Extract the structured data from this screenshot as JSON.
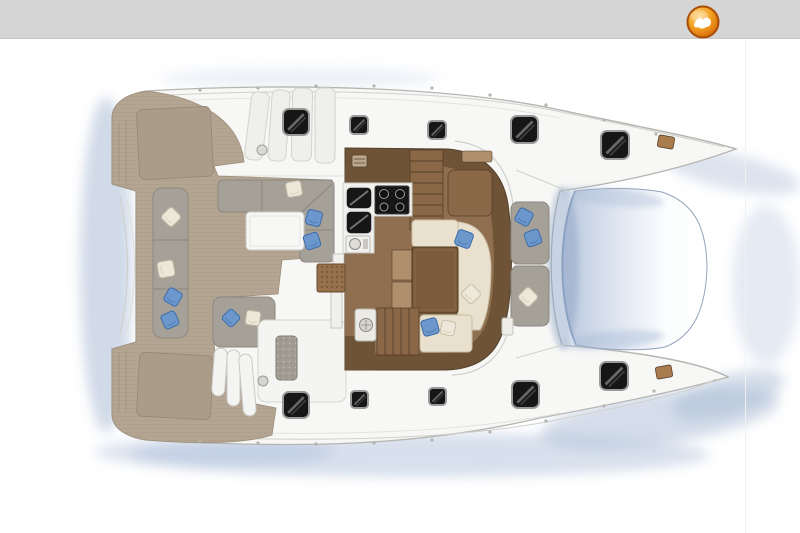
{
  "header": {
    "bar_color": "#d5d5d5",
    "bar_edge_color": "#c6c6c6",
    "logo": {
      "icon": "seabird-badge-logo-icon",
      "ring_color": "#a84c08",
      "glyph_color": "#ffffff",
      "gradient": [
        "#fdd683",
        "#f2a122",
        "#d96f0c",
        "#b45408"
      ]
    }
  },
  "boat": {
    "colors": {
      "hull": "#f7f7f5",
      "hull_stroke": "#b5b5b2",
      "deck_line": "#d0d0cd",
      "deck_line_faint": "#e2e2df",
      "teak": "#b4a593",
      "teak_stripe": "#9f917c",
      "teak_dark": "#aa9c89",
      "teak_dark_stroke": "#958773",
      "cushion_gray": "#a5a199",
      "cushion_border": "#8b877f",
      "pillow_blue": "#6b97cc",
      "pillow_blue_dark": "#3e6ca8",
      "pillow_white": "#eee8da",
      "pillow_white_border": "#c6bfa9",
      "wood_dark": "#6f5336",
      "wood_mid": "#8a6747",
      "wood_floor": "#8f6f50",
      "wood_light": "#b0906c",
      "wood_line": "#55402a",
      "galley_white": "#f2f1ee",
      "appliance_black": "#161616",
      "appliance_rim": "#9a9a9a",
      "table_white": "#f7f7f5",
      "table_brown": "#7b5b3b",
      "seat_cream": "#e9e1cd",
      "seat_cream_border": "#c9bfa6",
      "mat_brown": "#96714b",
      "mat_dot": "#6a4b2c",
      "tramp_dark": "#b9c7dd",
      "tramp_mid": "#dfe6f1",
      "tramp_light": "#fbfdfe",
      "tramp_edge": "#7f97bb",
      "hatch_black": "#161616",
      "hatch_rim": "#9a9a9a",
      "water_shadow": "#a9bbd6",
      "water_shadow_deep": "#8fa6c6",
      "panel_gray": "#a09c93",
      "fitting_brown": "#a97c4e"
    },
    "hatches": [
      {
        "x": 283,
        "y": 109,
        "size": 26
      },
      {
        "x": 350,
        "y": 116,
        "size": 18
      },
      {
        "x": 428,
        "y": 121,
        "size": 18
      },
      {
        "x": 511,
        "y": 116,
        "size": 27
      },
      {
        "x": 601,
        "y": 131,
        "size": 28
      },
      {
        "x": 283,
        "y": 392,
        "size": 26
      },
      {
        "x": 351,
        "y": 391,
        "size": 17
      },
      {
        "x": 429,
        "y": 388,
        "size": 17
      },
      {
        "x": 512,
        "y": 381,
        "size": 27
      },
      {
        "x": 600,
        "y": 362,
        "size": 28
      }
    ],
    "pillows": [
      {
        "x": 171,
        "y": 217,
        "size": 15,
        "rot": 45,
        "color": "white"
      },
      {
        "x": 166,
        "y": 269,
        "size": 16,
        "rot": 80,
        "color": "white"
      },
      {
        "x": 173,
        "y": 297,
        "size": 15,
        "rot": 30,
        "color": "blue"
      },
      {
        "x": 170,
        "y": 320,
        "size": 15,
        "rot": -25,
        "color": "blue"
      },
      {
        "x": 294,
        "y": 189,
        "size": 15,
        "rot": -10,
        "color": "white"
      },
      {
        "x": 314,
        "y": 218,
        "size": 15,
        "rot": 15,
        "color": "blue"
      },
      {
        "x": 312,
        "y": 241,
        "size": 15,
        "rot": -18,
        "color": "blue"
      },
      {
        "x": 231,
        "y": 318,
        "size": 14,
        "rot": 45,
        "color": "blue"
      },
      {
        "x": 253,
        "y": 318,
        "size": 14,
        "rot": 8,
        "color": "white"
      },
      {
        "x": 464,
        "y": 239,
        "size": 16,
        "rot": 20,
        "color": "blue"
      },
      {
        "x": 471,
        "y": 294,
        "size": 15,
        "rot": 45,
        "color": "white"
      },
      {
        "x": 430,
        "y": 327,
        "size": 16,
        "rot": -15,
        "color": "blue"
      },
      {
        "x": 448,
        "y": 328,
        "size": 14,
        "rot": 12,
        "color": "white"
      },
      {
        "x": 524,
        "y": 217,
        "size": 15,
        "rot": 28,
        "color": "blue"
      },
      {
        "x": 533,
        "y": 238,
        "size": 15,
        "rot": -20,
        "color": "blue"
      },
      {
        "x": 528,
        "y": 297,
        "size": 15,
        "rot": 45,
        "color": "white"
      }
    ],
    "deck_dots": [
      [
        200,
        90
      ],
      [
        258,
        88
      ],
      [
        316,
        86
      ],
      [
        374,
        86
      ],
      [
        432,
        88
      ],
      [
        490,
        95
      ],
      [
        546,
        105
      ],
      [
        604,
        120
      ],
      [
        656,
        134
      ],
      [
        200,
        441
      ],
      [
        258,
        443
      ],
      [
        316,
        444
      ],
      [
        374,
        443
      ],
      [
        432,
        440
      ],
      [
        490,
        432
      ],
      [
        546,
        421
      ],
      [
        604,
        406
      ],
      [
        654,
        391
      ]
    ]
  }
}
